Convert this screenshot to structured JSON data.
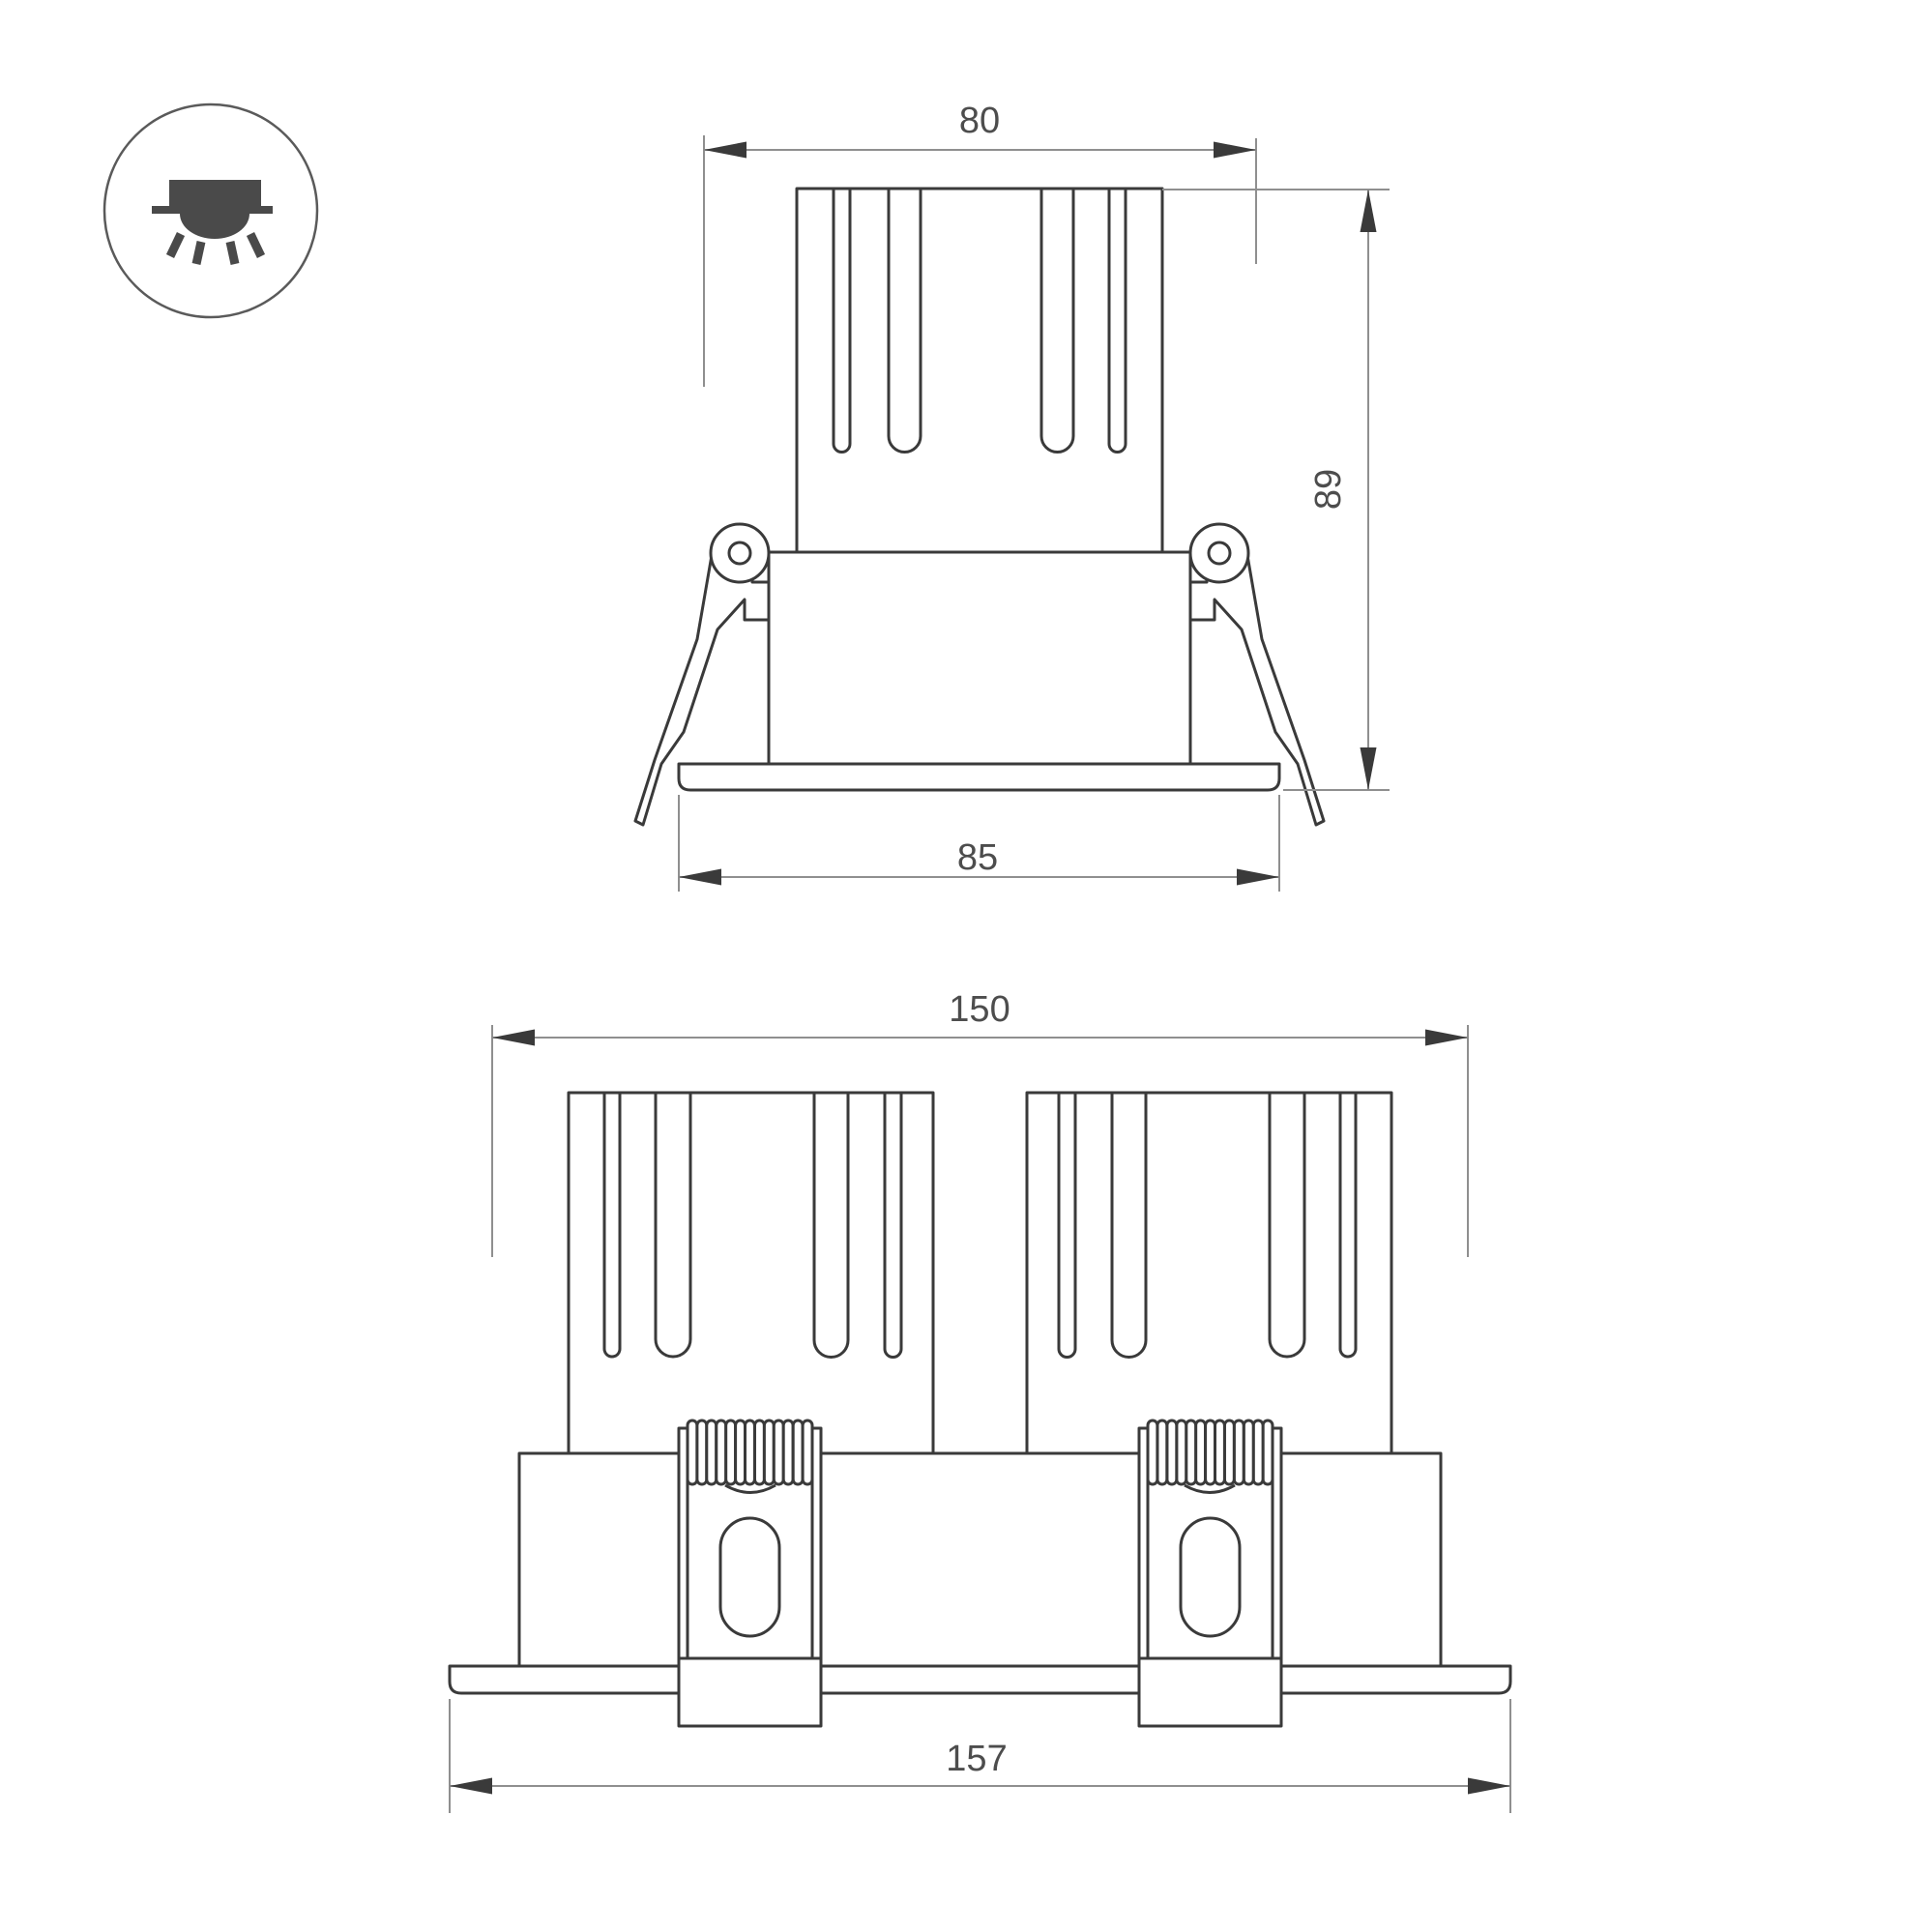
{
  "drawing": {
    "type": "luminaire-dimension-drawing",
    "background": "#ffffff",
    "colors": {
      "part_line": "#3a3a3a",
      "dimension_line": "#8f8f8f",
      "dimension_text": "#4d4d4d",
      "icon_glyph": "#4a4a4a"
    }
  },
  "icon": {
    "name": "recessed-downlight-icon",
    "parts": [
      "circle-outline",
      "fixture-body",
      "ceiling-line",
      "light-dome",
      "light-rays"
    ]
  },
  "front_view": {
    "name": "single-module-front-view",
    "dim_top_width": "80",
    "dim_height": "89",
    "dim_flange_width": "85"
  },
  "double_view": {
    "name": "double-module-front-view",
    "dim_top_width": "150",
    "dim_flange_width": "157"
  }
}
